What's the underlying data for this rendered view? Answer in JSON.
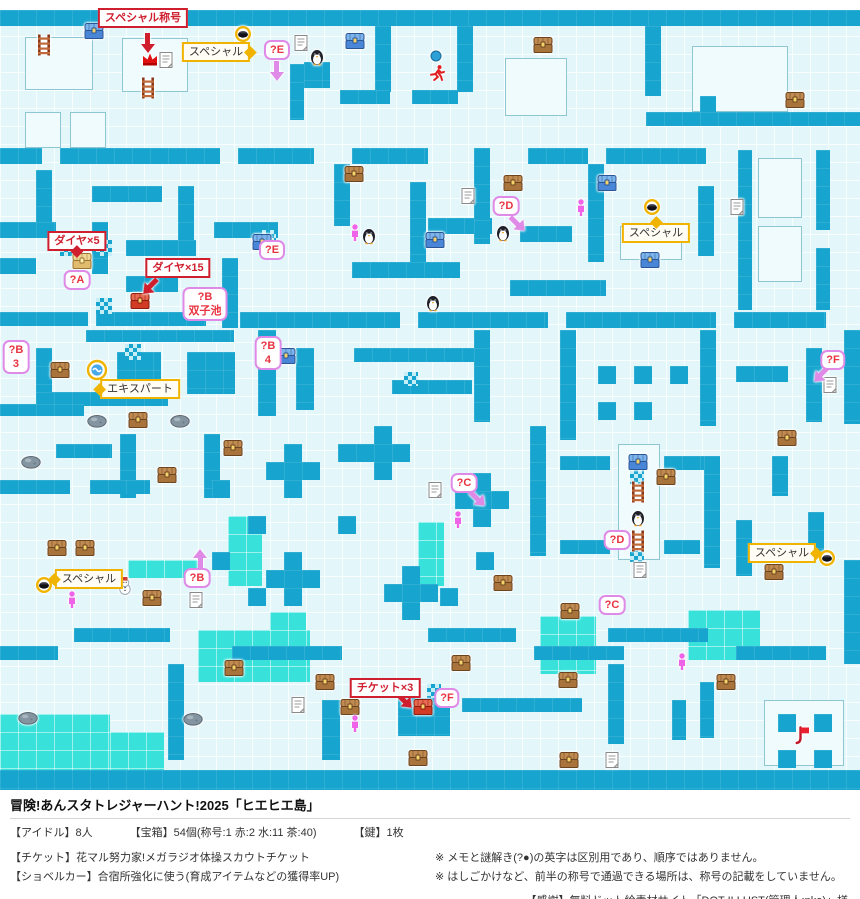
{
  "colors": {
    "wall": "#17a5cf",
    "bright": "#38e2da",
    "floor": "#e3f6fa",
    "red": "#cf1f2f",
    "yellow": "#f0b400",
    "pink": "#e08ae8",
    "person": "#ef63e8"
  },
  "footer": {
    "title": "冒険!あんスタトレジャーハント!2025「ヒエヒエ島」",
    "stats": {
      "idols": "【アイドル】8人",
      "chests": "【宝箱】54個(称号:1 赤:2 水:11 茶:40)",
      "key": "【鍵】1枚"
    },
    "ticket": "【チケット】花マル努力家!メガラジオ体操スカウトチケット",
    "shovel": "【ショベルカー】合宿所強化に使う(育成アイテムなどの獲得率UP)",
    "note1": "※ メモと謎解き(?●)の英字は区別用であり、順序ではありません。",
    "note2": "※ はしごかけなど、前半の称号で通過できる場所は、称号の記載をしていません。",
    "credit": "【感謝】無料ドット絵素材サイト「DOT ILLUST(管理人:nko)」様"
  },
  "map": {
    "walls": [
      [
        0,
        10,
        860,
        16
      ],
      [
        290,
        64,
        14,
        56
      ],
      [
        304,
        62,
        26,
        26
      ],
      [
        375,
        26,
        16,
        66
      ],
      [
        457,
        26,
        16,
        66
      ],
      [
        645,
        26,
        16,
        70
      ],
      [
        340,
        90,
        50,
        14
      ],
      [
        412,
        90,
        46,
        14
      ],
      [
        646,
        112,
        214,
        14
      ],
      [
        700,
        96,
        16,
        16
      ],
      [
        0,
        148,
        42,
        16
      ],
      [
        60,
        148,
        160,
        16
      ],
      [
        238,
        148,
        76,
        16
      ],
      [
        36,
        170,
        16,
        52
      ],
      [
        92,
        186,
        70,
        16
      ],
      [
        0,
        222,
        56,
        16
      ],
      [
        92,
        222,
        16,
        52
      ],
      [
        126,
        240,
        70,
        16
      ],
      [
        178,
        186,
        16,
        70
      ],
      [
        214,
        222,
        64,
        16
      ],
      [
        0,
        258,
        36,
        16
      ],
      [
        126,
        276,
        52,
        16
      ],
      [
        0,
        312,
        88,
        14
      ],
      [
        96,
        312,
        110,
        14
      ],
      [
        222,
        258,
        16,
        70
      ],
      [
        334,
        164,
        16,
        62
      ],
      [
        352,
        148,
        76,
        16
      ],
      [
        410,
        182,
        16,
        80
      ],
      [
        428,
        218,
        64,
        16
      ],
      [
        352,
        262,
        108,
        16
      ],
      [
        474,
        148,
        16,
        96
      ],
      [
        520,
        226,
        52,
        16
      ],
      [
        528,
        148,
        60,
        16
      ],
      [
        588,
        164,
        16,
        98
      ],
      [
        510,
        280,
        96,
        16
      ],
      [
        606,
        148,
        100,
        16
      ],
      [
        738,
        150,
        14,
        160
      ],
      [
        816,
        150,
        14,
        80
      ],
      [
        816,
        248,
        14,
        62
      ],
      [
        698,
        186,
        16,
        70
      ],
      [
        240,
        312,
        160,
        16
      ],
      [
        418,
        312,
        130,
        16
      ],
      [
        566,
        312,
        150,
        16
      ],
      [
        734,
        312,
        92,
        16
      ],
      [
        86,
        330,
        148,
        12
      ],
      [
        258,
        330,
        18,
        86
      ],
      [
        36,
        348,
        16,
        44
      ],
      [
        117,
        352,
        44,
        42
      ],
      [
        187,
        352,
        48,
        42
      ],
      [
        36,
        392,
        132,
        14
      ],
      [
        296,
        348,
        18,
        62
      ],
      [
        354,
        348,
        120,
        14
      ],
      [
        392,
        380,
        80,
        14
      ],
      [
        474,
        330,
        16,
        92
      ],
      [
        560,
        330,
        16,
        110
      ],
      [
        598,
        366,
        18,
        18
      ],
      [
        634,
        366,
        18,
        18
      ],
      [
        670,
        366,
        18,
        18
      ],
      [
        598,
        402,
        18,
        18
      ],
      [
        634,
        402,
        18,
        18
      ],
      [
        700,
        330,
        16,
        96
      ],
      [
        736,
        366,
        52,
        16
      ],
      [
        806,
        348,
        16,
        74
      ],
      [
        844,
        330,
        16,
        94
      ],
      [
        120,
        434,
        16,
        64
      ],
      [
        204,
        434,
        16,
        64
      ],
      [
        0,
        404,
        84,
        12
      ],
      [
        56,
        444,
        56,
        14
      ],
      [
        0,
        480,
        70,
        14
      ],
      [
        90,
        480,
        60,
        14
      ],
      [
        284,
        444,
        18,
        54
      ],
      [
        266,
        462,
        54,
        18
      ],
      [
        374,
        426,
        18,
        54
      ],
      [
        356,
        444,
        54,
        18
      ],
      [
        473,
        473,
        18,
        54
      ],
      [
        455,
        491,
        54,
        18
      ],
      [
        284,
        552,
        18,
        54
      ],
      [
        266,
        570,
        54,
        18
      ],
      [
        402,
        566,
        18,
        54
      ],
      [
        384,
        584,
        54,
        18
      ],
      [
        476,
        552,
        18,
        18
      ],
      [
        212,
        480,
        18,
        18
      ],
      [
        248,
        516,
        18,
        18
      ],
      [
        338,
        516,
        18,
        18
      ],
      [
        212,
        552,
        18,
        18
      ],
      [
        338,
        444,
        18,
        18
      ],
      [
        248,
        588,
        18,
        18
      ],
      [
        440,
        588,
        18,
        18
      ],
      [
        530,
        426,
        16,
        130
      ],
      [
        560,
        456,
        50,
        14
      ],
      [
        664,
        456,
        40,
        14
      ],
      [
        704,
        456,
        16,
        112
      ],
      [
        736,
        520,
        16,
        56
      ],
      [
        772,
        456,
        16,
        40
      ],
      [
        808,
        512,
        16,
        40
      ],
      [
        560,
        540,
        50,
        14
      ],
      [
        664,
        540,
        36,
        14
      ],
      [
        844,
        560,
        16,
        104
      ],
      [
        0,
        646,
        58,
        14
      ],
      [
        74,
        628,
        96,
        14
      ],
      [
        168,
        664,
        16,
        96
      ],
      [
        232,
        646,
        110,
        14
      ],
      [
        322,
        700,
        18,
        60
      ],
      [
        398,
        698,
        52,
        38
      ],
      [
        428,
        628,
        88,
        14
      ],
      [
        462,
        698,
        120,
        14
      ],
      [
        534,
        646,
        90,
        14
      ],
      [
        608,
        664,
        16,
        80
      ],
      [
        672,
        700,
        14,
        40
      ],
      [
        608,
        628,
        100,
        14
      ],
      [
        736,
        646,
        90,
        14
      ],
      [
        700,
        682,
        14,
        56
      ],
      [
        778,
        714,
        18,
        18
      ],
      [
        814,
        714,
        18,
        18
      ],
      [
        778,
        750,
        18,
        18
      ],
      [
        814,
        750,
        18,
        18
      ],
      [
        0,
        770,
        860,
        20
      ]
    ],
    "rooms": [
      [
        25,
        37,
        68,
        53
      ],
      [
        122,
        38,
        66,
        54
      ],
      [
        25,
        112,
        36,
        36
      ],
      [
        70,
        112,
        36,
        36
      ],
      [
        505,
        58,
        62,
        58
      ],
      [
        692,
        46,
        96,
        66
      ],
      [
        758,
        158,
        44,
        60
      ],
      [
        758,
        226,
        44,
        56
      ],
      [
        618,
        444,
        42,
        116
      ],
      [
        620,
        226,
        62,
        34
      ],
      [
        764,
        700,
        80,
        66
      ]
    ],
    "bright": [
      [
        228,
        516,
        34,
        70
      ],
      [
        418,
        522,
        26,
        64
      ],
      [
        198,
        630,
        112,
        52
      ],
      [
        270,
        612,
        36,
        18
      ],
      [
        540,
        616,
        56,
        58
      ],
      [
        688,
        610,
        72,
        50
      ],
      [
        0,
        714,
        110,
        56
      ],
      [
        110,
        732,
        54,
        38
      ],
      [
        128,
        560,
        72,
        18
      ]
    ],
    "checker": [
      [
        60,
        240,
        16,
        16
      ],
      [
        96,
        240,
        16,
        16
      ],
      [
        96,
        298,
        16,
        16
      ],
      [
        125,
        344,
        16,
        16
      ],
      [
        262,
        230,
        14,
        14
      ],
      [
        427,
        684,
        14,
        14
      ],
      [
        630,
        470,
        14,
        14
      ],
      [
        630,
        548,
        14,
        14
      ],
      [
        404,
        372,
        14,
        14
      ]
    ],
    "markers": [
      {
        "t": "chest-blue",
        "x": 94,
        "y": 31
      },
      {
        "t": "chest-blue",
        "x": 355,
        "y": 41
      },
      {
        "t": "chest-blue",
        "x": 607,
        "y": 183
      },
      {
        "t": "chest-blue",
        "x": 650,
        "y": 260
      },
      {
        "t": "chest-blue",
        "x": 435,
        "y": 240
      },
      {
        "t": "chest-blue",
        "x": 286,
        "y": 356
      },
      {
        "t": "chest-blue",
        "x": 262,
        "y": 242
      },
      {
        "t": "chest-blue",
        "x": 638,
        "y": 462
      },
      {
        "t": "chest-brown",
        "x": 543,
        "y": 45
      },
      {
        "t": "chest-brown",
        "x": 795,
        "y": 100
      },
      {
        "t": "chest-brown",
        "x": 513,
        "y": 183
      },
      {
        "t": "chest-brown",
        "x": 354,
        "y": 174
      },
      {
        "t": "chest-brown",
        "x": 60,
        "y": 370
      },
      {
        "t": "chest-brown",
        "x": 138,
        "y": 420
      },
      {
        "t": "chest-brown",
        "x": 233,
        "y": 448
      },
      {
        "t": "chest-brown",
        "x": 167,
        "y": 475
      },
      {
        "t": "chest-brown",
        "x": 57,
        "y": 548
      },
      {
        "t": "chest-brown",
        "x": 85,
        "y": 548
      },
      {
        "t": "chest-brown",
        "x": 152,
        "y": 598
      },
      {
        "t": "chest-brown",
        "x": 503,
        "y": 583
      },
      {
        "t": "chest-brown",
        "x": 570,
        "y": 611
      },
      {
        "t": "chest-brown",
        "x": 666,
        "y": 477
      },
      {
        "t": "chest-brown",
        "x": 787,
        "y": 438
      },
      {
        "t": "chest-brown",
        "x": 774,
        "y": 572
      },
      {
        "t": "chest-brown",
        "x": 234,
        "y": 668
      },
      {
        "t": "chest-brown",
        "x": 325,
        "y": 682
      },
      {
        "t": "chest-brown",
        "x": 350,
        "y": 707
      },
      {
        "t": "chest-brown",
        "x": 461,
        "y": 663
      },
      {
        "t": "chest-brown",
        "x": 568,
        "y": 680
      },
      {
        "t": "chest-brown",
        "x": 569,
        "y": 760
      },
      {
        "t": "chest-brown",
        "x": 726,
        "y": 682
      },
      {
        "t": "chest-brown",
        "x": 418,
        "y": 758
      },
      {
        "t": "chest-red",
        "x": 140,
        "y": 301
      },
      {
        "t": "chest-red",
        "x": 423,
        "y": 707
      },
      {
        "t": "chest-gold",
        "x": 82,
        "y": 261
      },
      {
        "t": "memo",
        "x": 166,
        "y": 60
      },
      {
        "t": "memo",
        "x": 301,
        "y": 43
      },
      {
        "t": "memo",
        "x": 468,
        "y": 196
      },
      {
        "t": "memo",
        "x": 737,
        "y": 207
      },
      {
        "t": "memo",
        "x": 830,
        "y": 385
      },
      {
        "t": "memo",
        "x": 435,
        "y": 490
      },
      {
        "t": "memo",
        "x": 640,
        "y": 570
      },
      {
        "t": "memo",
        "x": 196,
        "y": 600
      },
      {
        "t": "memo",
        "x": 298,
        "y": 705
      },
      {
        "t": "memo",
        "x": 612,
        "y": 760
      },
      {
        "t": "penguin",
        "x": 317,
        "y": 57
      },
      {
        "t": "penguin",
        "x": 369,
        "y": 236
      },
      {
        "t": "penguin",
        "x": 433,
        "y": 303
      },
      {
        "t": "penguin",
        "x": 503,
        "y": 233
      },
      {
        "t": "penguin",
        "x": 638,
        "y": 518
      },
      {
        "t": "snowman",
        "x": 125,
        "y": 586
      },
      {
        "t": "person",
        "x": 581,
        "y": 208
      },
      {
        "t": "person",
        "x": 355,
        "y": 233
      },
      {
        "t": "person",
        "x": 458,
        "y": 520
      },
      {
        "t": "person",
        "x": 72,
        "y": 600
      },
      {
        "t": "person",
        "x": 355,
        "y": 724
      },
      {
        "t": "person",
        "x": 682,
        "y": 662
      },
      {
        "t": "runner",
        "x": 437,
        "y": 73
      },
      {
        "t": "dot",
        "x": 436,
        "y": 56
      },
      {
        "t": "crown",
        "x": 150,
        "y": 59
      },
      {
        "t": "hole",
        "x": 243,
        "y": 34
      },
      {
        "t": "hole",
        "x": 652,
        "y": 207
      },
      {
        "t": "hole",
        "x": 44,
        "y": 585
      },
      {
        "t": "hole",
        "x": 827,
        "y": 558
      },
      {
        "t": "expert",
        "x": 97,
        "y": 370
      },
      {
        "t": "rock",
        "x": 31,
        "y": 462
      },
      {
        "t": "rock",
        "x": 97,
        "y": 421
      },
      {
        "t": "rock",
        "x": 180,
        "y": 421
      },
      {
        "t": "rock",
        "x": 28,
        "y": 718
      },
      {
        "t": "rock",
        "x": 193,
        "y": 719
      },
      {
        "t": "ladder",
        "x": 44,
        "y": 45
      },
      {
        "t": "ladder",
        "x": 148,
        "y": 88
      },
      {
        "t": "ladder",
        "x": 638,
        "y": 492
      },
      {
        "t": "ladder",
        "x": 638,
        "y": 541
      },
      {
        "t": "flag",
        "x": 802,
        "y": 736
      }
    ],
    "callouts": [
      {
        "s": "r",
        "l": [
          "スペシャル称号"
        ],
        "x": 143,
        "y": 18
      },
      {
        "s": "y",
        "l": [
          "スペシャル"
        ],
        "x": 216,
        "y": 52,
        "tail": "right"
      },
      {
        "s": "p",
        "l": [
          "?E"
        ],
        "x": 277,
        "y": 50
      },
      {
        "s": "r",
        "l": [
          "ダイヤ×5"
        ],
        "x": 77,
        "y": 241,
        "tail": "down"
      },
      {
        "s": "p",
        "l": [
          "?A"
        ],
        "x": 77,
        "y": 280
      },
      {
        "s": "r",
        "l": [
          "ダイヤ×15"
        ],
        "x": 178,
        "y": 268
      },
      {
        "s": "p",
        "l": [
          "?B",
          "双子池"
        ],
        "x": 205,
        "y": 304
      },
      {
        "s": "p",
        "l": [
          "?E"
        ],
        "x": 272,
        "y": 250
      },
      {
        "s": "p",
        "l": [
          "?B",
          "3"
        ],
        "x": 16,
        "y": 357
      },
      {
        "s": "y",
        "l": [
          "エキスパート"
        ],
        "x": 140,
        "y": 389,
        "tail": "left"
      },
      {
        "s": "p",
        "l": [
          "?B",
          "4"
        ],
        "x": 268,
        "y": 353
      },
      {
        "s": "p",
        "l": [
          "?D"
        ],
        "x": 506,
        "y": 206
      },
      {
        "s": "y",
        "l": [
          "スペシャル"
        ],
        "x": 656,
        "y": 233,
        "tail": "up"
      },
      {
        "s": "p",
        "l": [
          "?F"
        ],
        "x": 833,
        "y": 360
      },
      {
        "s": "p",
        "l": [
          "?C"
        ],
        "x": 464,
        "y": 483
      },
      {
        "s": "p",
        "l": [
          "?D"
        ],
        "x": 617,
        "y": 540
      },
      {
        "s": "p",
        "l": [
          "?C"
        ],
        "x": 612,
        "y": 605
      },
      {
        "s": "y",
        "l": [
          "スペシャル"
        ],
        "x": 89,
        "y": 579,
        "tail": "left"
      },
      {
        "s": "p",
        "l": [
          "?B"
        ],
        "x": 197,
        "y": 578
      },
      {
        "s": "y",
        "l": [
          "スペシャル"
        ],
        "x": 782,
        "y": 553,
        "tail": "right"
      },
      {
        "s": "r",
        "l": [
          "チケット×3"
        ],
        "x": 385,
        "y": 688
      },
      {
        "s": "p",
        "l": [
          "?F"
        ],
        "x": 447,
        "y": 698
      }
    ],
    "arrows": [
      {
        "dir": "down",
        "x": 148,
        "y": 42,
        "c": "red"
      },
      {
        "dir": "down-left",
        "x": 151,
        "y": 286,
        "c": "red"
      },
      {
        "dir": "down-right",
        "x": 404,
        "y": 700,
        "c": "red"
      },
      {
        "dir": "down",
        "x": 277,
        "y": 70,
        "c": "pink"
      },
      {
        "dir": "down-right",
        "x": 517,
        "y": 223,
        "c": "pink"
      },
      {
        "dir": "down-left",
        "x": 822,
        "y": 374,
        "c": "pink"
      },
      {
        "dir": "down-right",
        "x": 477,
        "y": 498,
        "c": "pink"
      },
      {
        "dir": "up",
        "x": 200,
        "y": 560,
        "c": "pink"
      }
    ]
  }
}
